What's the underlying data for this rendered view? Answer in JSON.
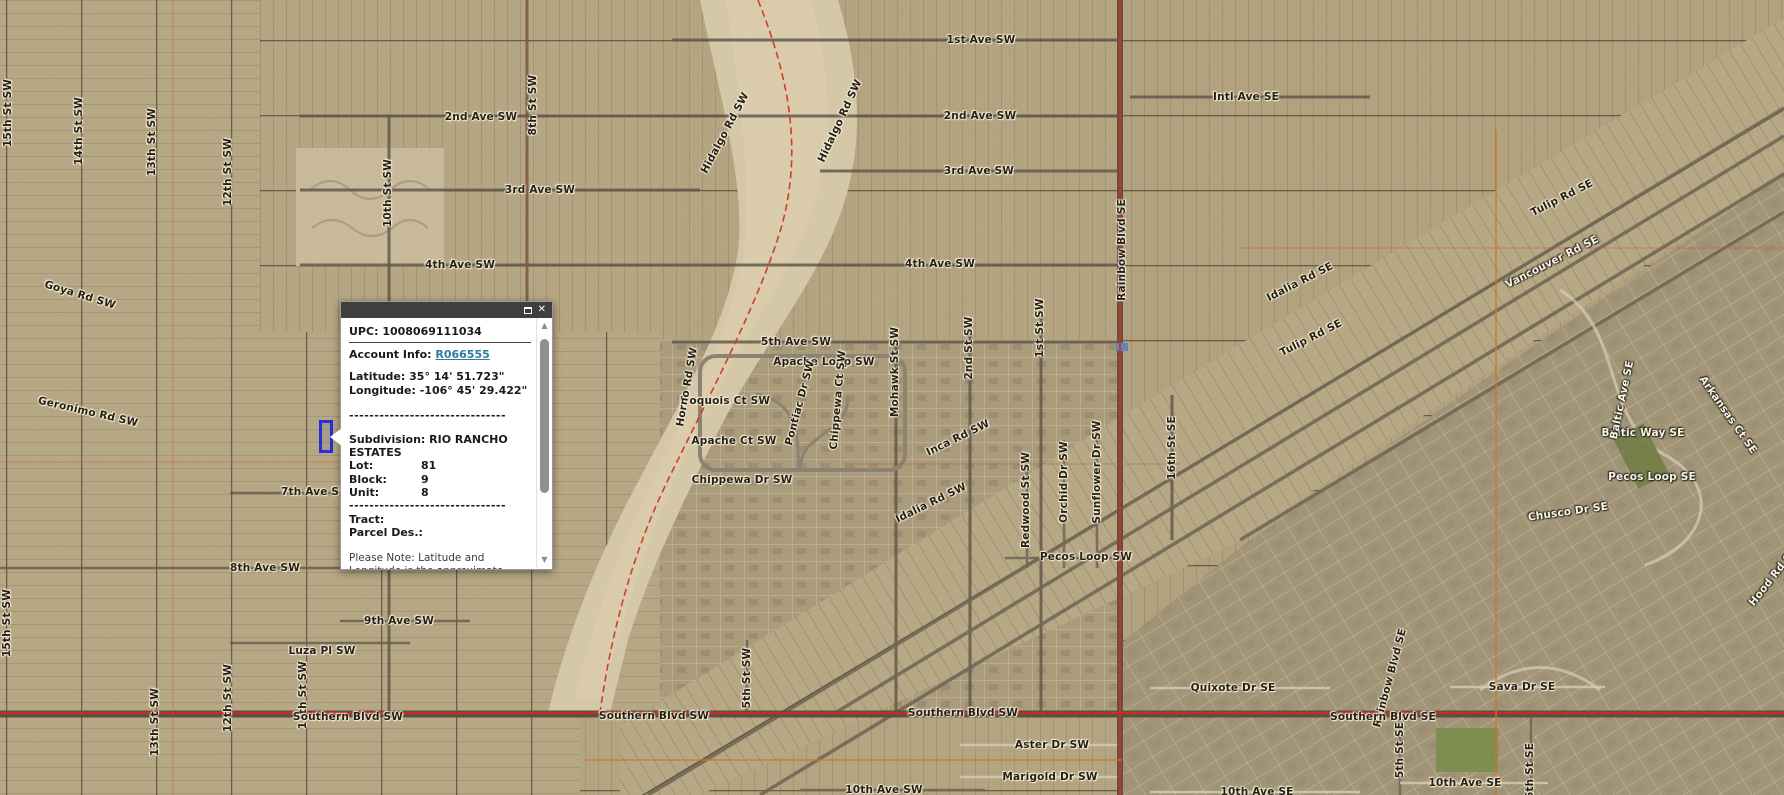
{
  "popup": {
    "upc_label": "UPC:",
    "upc": "1008069111034",
    "account_label": "Account Info:",
    "account_link": "R066555",
    "latitude_label": "Latitude:",
    "latitude": "35° 14' 51.723\"",
    "longitude_label": "Longitude:",
    "longitude": "-106° 45' 29.422\"",
    "separator": "-------------------------------",
    "subdivision_label": "Subdivision:",
    "subdivision": "RIO RANCHO ESTATES",
    "fields": [
      {
        "label": "Lot:",
        "value": "81"
      },
      {
        "label": "Block:",
        "value": "9"
      },
      {
        "label": "Unit:",
        "value": "8"
      }
    ],
    "tract_label": "Tract:",
    "parcel_des_label": "Parcel Des.:",
    "note": "Please Note: Latitude and Longitude is the approximate center of the parcel shown",
    "controls": {
      "close_glyph": "✕"
    },
    "scrollbar": {
      "up_glyph": "▲",
      "down_glyph": "▼"
    }
  },
  "map": {
    "colors": {
      "selected_parcel_outline": "#2d2dd6",
      "boundary_line_red": "#cf3a22",
      "road_centerline_red": "#c9261b",
      "section_line_orange": "#d4712c",
      "link_teal": "#2a7d9c",
      "titlebar_gray": "#3f3f3f"
    },
    "highlighted_parcel": {
      "x": 319,
      "y": 420,
      "width": 14,
      "height": 33
    },
    "labels": [
      {
        "text": "1st Ave SW",
        "x": 981,
        "y": 40
      },
      {
        "text": "2nd Ave SW",
        "x": 980,
        "y": 116
      },
      {
        "text": "2nd Ave SW",
        "x": 481,
        "y": 117
      },
      {
        "text": "3rd Ave SW",
        "x": 540,
        "y": 190
      },
      {
        "text": "3rd Ave SW",
        "x": 979,
        "y": 171
      },
      {
        "text": "4th Ave SW",
        "x": 460,
        "y": 265
      },
      {
        "text": "4th Ave SW",
        "x": 940,
        "y": 264
      },
      {
        "text": "5th Ave SW",
        "x": 796,
        "y": 342
      },
      {
        "text": "Intl Ave SE",
        "x": 1246,
        "y": 97
      },
      {
        "text": "Goya Rd SW",
        "x": 80,
        "y": 295,
        "rot": 17
      },
      {
        "text": "Geronimo Rd SW",
        "x": 88,
        "y": 412,
        "rot": 13
      },
      {
        "text": "15th St SW",
        "x": 8,
        "y": 113,
        "rot": -90
      },
      {
        "text": "14th St SW",
        "x": 79,
        "y": 131,
        "rot": -90
      },
      {
        "text": "13th St SW",
        "x": 152,
        "y": 142,
        "rot": -90
      },
      {
        "text": "12th St SW",
        "x": 228,
        "y": 172,
        "rot": -90
      },
      {
        "text": "10th St SW",
        "x": 388,
        "y": 193,
        "rot": -90
      },
      {
        "text": "8th St SW",
        "x": 533,
        "y": 105,
        "rot": -90
      },
      {
        "text": "Hidalgo Rd SW",
        "x": 725,
        "y": 133,
        "rot": -62
      },
      {
        "text": "Hidalgo Rd SW",
        "x": 840,
        "y": 121,
        "rot": -65
      },
      {
        "text": "Mohawk St SW",
        "x": 895,
        "y": 372,
        "rot": -90
      },
      {
        "text": "2nd St SW",
        "x": 969,
        "y": 348,
        "rot": -90
      },
      {
        "text": "1st St SW",
        "x": 1040,
        "y": 328,
        "rot": -90
      },
      {
        "text": "Apache Loop SW",
        "x": 824,
        "y": 362
      },
      {
        "text": "Iroquois Ct SW",
        "x": 725,
        "y": 401
      },
      {
        "text": "Apache Ct SW",
        "x": 734,
        "y": 441
      },
      {
        "text": "Chippewa Dr SW",
        "x": 742,
        "y": 480
      },
      {
        "text": "Pontiac Dr SW",
        "x": 800,
        "y": 403,
        "rot": -75
      },
      {
        "text": "Chippewa Ct SW",
        "x": 838,
        "y": 400,
        "rot": -85
      },
      {
        "text": "Horno Rd SW",
        "x": 687,
        "y": 387,
        "rot": -80
      },
      {
        "text": "Inca Rd SW",
        "x": 958,
        "y": 438,
        "rot": -26
      },
      {
        "text": "Idalia Rd SW",
        "x": 931,
        "y": 503,
        "rot": -26
      },
      {
        "text": "Idalia Rd SE",
        "x": 1300,
        "y": 282,
        "rot": -27
      },
      {
        "text": "Tulip Rd SE",
        "x": 1562,
        "y": 198,
        "rot": -27
      },
      {
        "text": "Tulip Rd SE",
        "x": 1311,
        "y": 338,
        "rot": -27
      },
      {
        "text": "Vancouver Rd SE",
        "x": 1552,
        "y": 262,
        "rot": -27,
        "variant": "light"
      },
      {
        "text": "Rainbow Blvd SE",
        "x": 1122,
        "y": 250,
        "rot": -90
      },
      {
        "text": "Rainbow Blvd SE",
        "x": 1390,
        "y": 678,
        "rot": -75
      },
      {
        "text": "16th St SE",
        "x": 1172,
        "y": 448,
        "rot": -90
      },
      {
        "text": "Redwood St SW",
        "x": 1026,
        "y": 500,
        "rot": -90
      },
      {
        "text": "Orchid Dr SW",
        "x": 1064,
        "y": 482,
        "rot": -90
      },
      {
        "text": "Sunflower Dr SW",
        "x": 1097,
        "y": 472,
        "rot": -90
      },
      {
        "text": "Pecos Loop SW",
        "x": 1086,
        "y": 557
      },
      {
        "text": "7th Ave SW",
        "x": 316,
        "y": 492
      },
      {
        "text": "8th Ave SW",
        "x": 265,
        "y": 568
      },
      {
        "text": "9th Ave SW",
        "x": 399,
        "y": 621
      },
      {
        "text": "Luza Pl SW",
        "x": 322,
        "y": 651
      },
      {
        "text": "15th St SW",
        "x": 7,
        "y": 623,
        "rot": -90
      },
      {
        "text": "13th St SW",
        "x": 155,
        "y": 722,
        "rot": -90
      },
      {
        "text": "12th St SW",
        "x": 228,
        "y": 698,
        "rot": -90
      },
      {
        "text": "11th St SW",
        "x": 303,
        "y": 695,
        "rot": -90
      },
      {
        "text": "5th St SW",
        "x": 747,
        "y": 678,
        "rot": -90
      },
      {
        "text": "Southern Blvd SW",
        "x": 348,
        "y": 717
      },
      {
        "text": "Southern Blvd SW",
        "x": 654,
        "y": 716
      },
      {
        "text": "Southern Blvd SW",
        "x": 963,
        "y": 713
      },
      {
        "text": "Southern Blvd SE",
        "x": 1383,
        "y": 717
      },
      {
        "text": "10th Ave SW",
        "x": 884,
        "y": 790
      },
      {
        "text": "Aster Dr SW",
        "x": 1052,
        "y": 745
      },
      {
        "text": "Marigold Dr SW",
        "x": 1050,
        "y": 777
      },
      {
        "text": "Quixote Dr SE",
        "x": 1233,
        "y": 688
      },
      {
        "text": "Sava Dr SE",
        "x": 1522,
        "y": 687
      },
      {
        "text": "10th Ave SE",
        "x": 1257,
        "y": 792
      },
      {
        "text": "10th Ave SE",
        "x": 1465,
        "y": 783
      },
      {
        "text": "5th St SE",
        "x": 1400,
        "y": 750,
        "rot": -90
      },
      {
        "text": "6th St SE",
        "x": 1530,
        "y": 771,
        "rot": -90
      },
      {
        "text": "Baltic Way SE",
        "x": 1643,
        "y": 433,
        "variant": "light"
      },
      {
        "text": "Baltic Ave SE",
        "x": 1622,
        "y": 400,
        "rot": -78,
        "variant": "light"
      },
      {
        "text": "Pecos Loop SE",
        "x": 1652,
        "y": 477,
        "variant": "light"
      },
      {
        "text": "Chusco Dr SE",
        "x": 1568,
        "y": 512,
        "rot": -8,
        "variant": "light"
      },
      {
        "text": "Arkansas Ct SE",
        "x": 1728,
        "y": 415,
        "rot": 55,
        "variant": "light"
      },
      {
        "text": "Hood Rd SE",
        "x": 1773,
        "y": 577,
        "rot": -52,
        "variant": "light"
      }
    ]
  }
}
